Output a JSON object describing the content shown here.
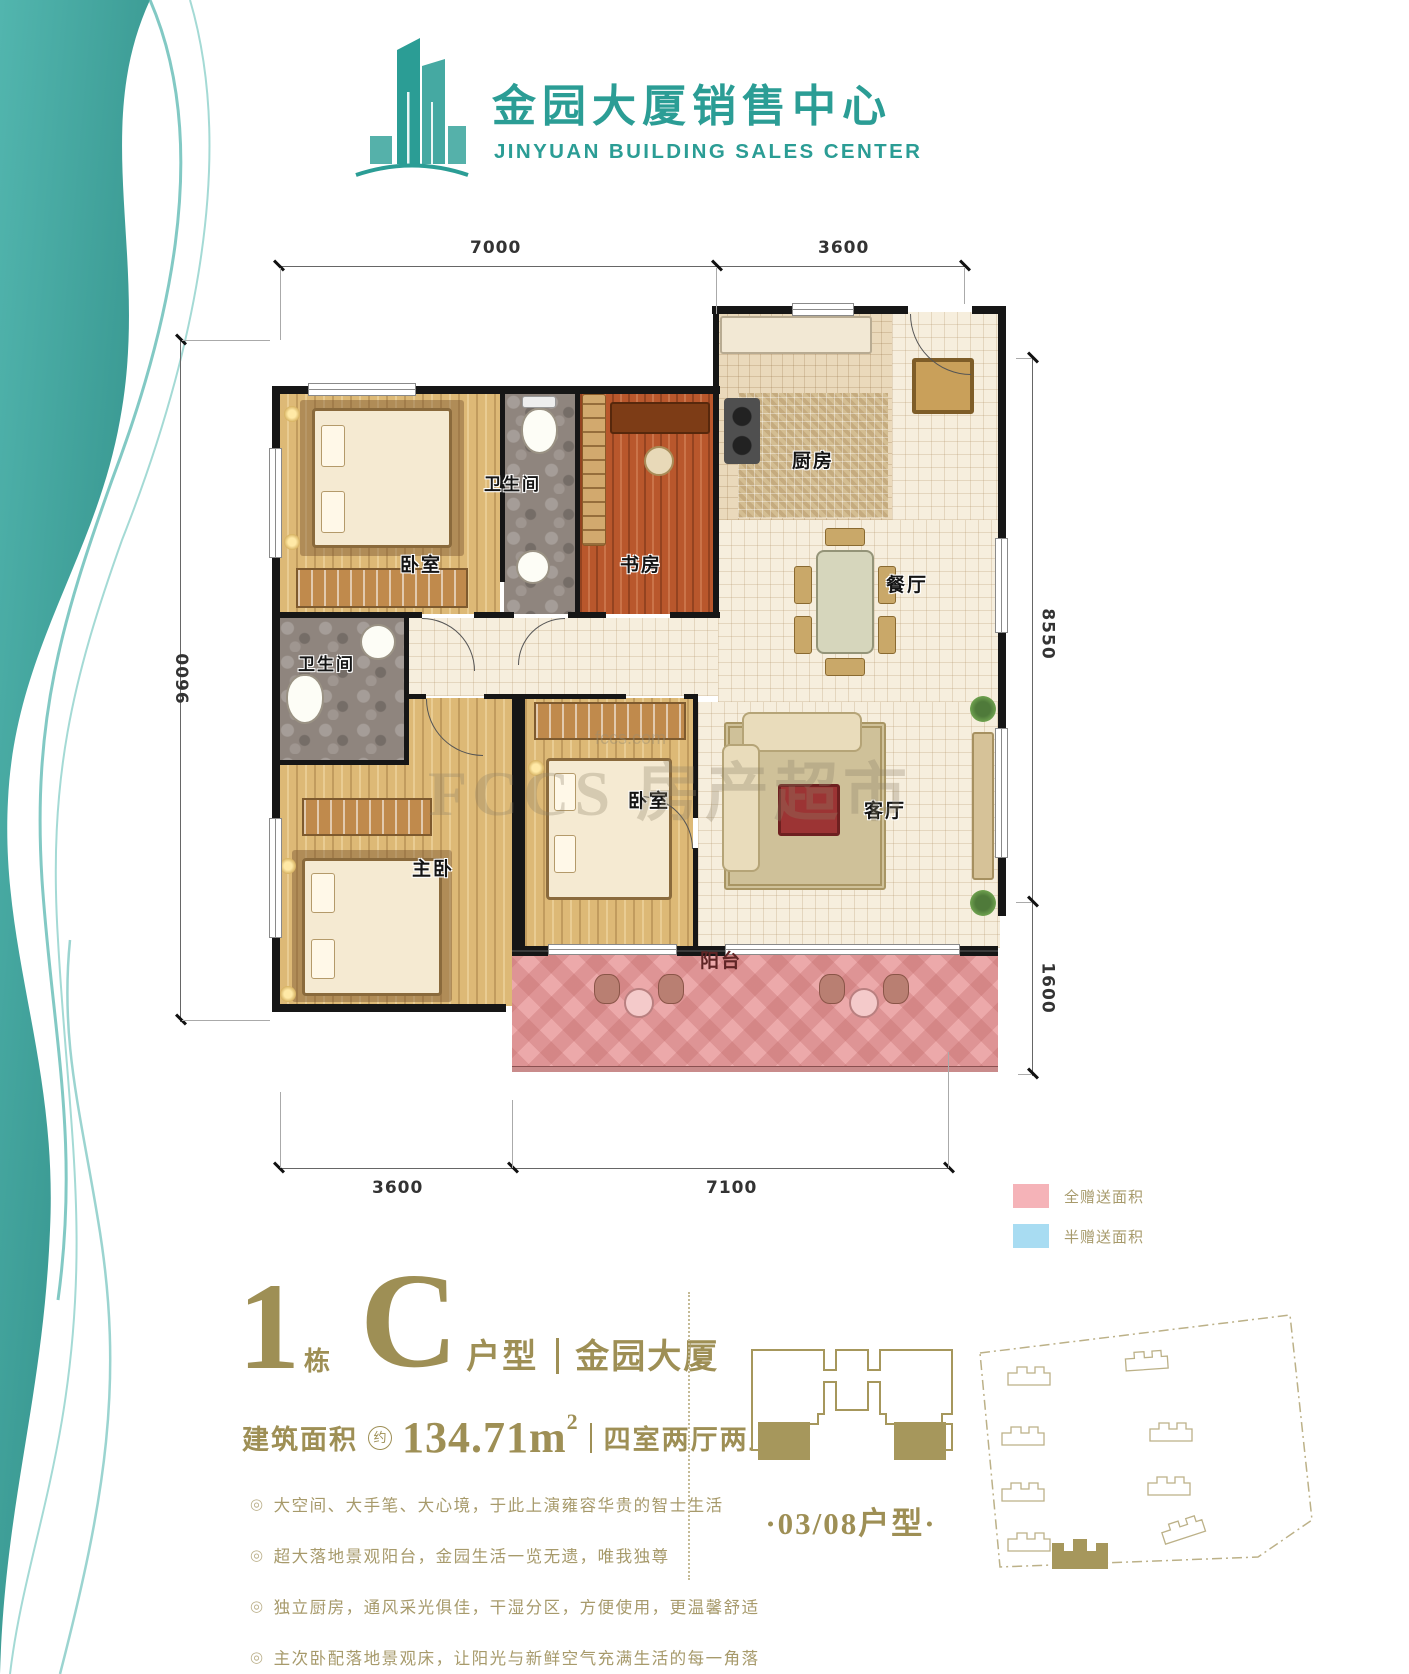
{
  "header": {
    "title": "金园大厦销售中心",
    "subtitle": "JINYUAN BUILDING SALES CENTER"
  },
  "colors": {
    "teal": "#2B9D95",
    "gold": "#9E8F55",
    "full_gift_pink": "#F5B3B8",
    "half_gift_blue": "#A8DCF2",
    "balcony_pink": "#ECA9AA",
    "wall_black": "#161616"
  },
  "plan": {
    "rooms": [
      {
        "name": "bedroom-1",
        "label": "卧室"
      },
      {
        "name": "bathroom-1",
        "label": "卫生间"
      },
      {
        "name": "study",
        "label": "书房"
      },
      {
        "name": "kitchen",
        "label": "厨房"
      },
      {
        "name": "dining-room",
        "label": "餐厅"
      },
      {
        "name": "bathroom-2",
        "label": "卫生间"
      },
      {
        "name": "master-bedroom",
        "label": "主卧"
      },
      {
        "name": "bedroom-2",
        "label": "卧室"
      },
      {
        "name": "living-room",
        "label": "客厅"
      },
      {
        "name": "balcony",
        "label": "阳台"
      }
    ],
    "dimensions": {
      "top": [
        "7000",
        "3600"
      ],
      "left": [
        "9600"
      ],
      "right": [
        "8550",
        "1600"
      ],
      "bottom": [
        "3600",
        "7100"
      ]
    },
    "watermark": {
      "brand": "FCCS",
      "text": "房产超市",
      "domain": "fccs.com"
    }
  },
  "legend": [
    {
      "name": "full-gift-area",
      "label": "全赠送面积",
      "color": "#F5B3B8"
    },
    {
      "name": "half-gift-area",
      "label": "半赠送面积",
      "color": "#A8DCF2"
    }
  ],
  "info": {
    "building_no": "1",
    "building_suffix": "栋",
    "type_letter": "C",
    "type_suffix": "户型",
    "project_name": "金园大厦",
    "area_label": "建筑面积",
    "area_circle": "约",
    "area_value": "134.71m",
    "area_exp": "2",
    "layout_desc": "四室两厅两卫",
    "features": [
      "大空间、大手笔、大心境，于此上演雍容华贵的智士生活",
      "超大落地景观阳台，金园生活一览无遗，唯我独尊",
      "独立厨房，通风采光俱佳，干湿分区，方便使用，更温馨舒适",
      "主次卧配落地景观床，让阳光与新鲜空气充满生活的每一角落"
    ]
  },
  "keyplate": {
    "caption": "·03/08户型·"
  }
}
